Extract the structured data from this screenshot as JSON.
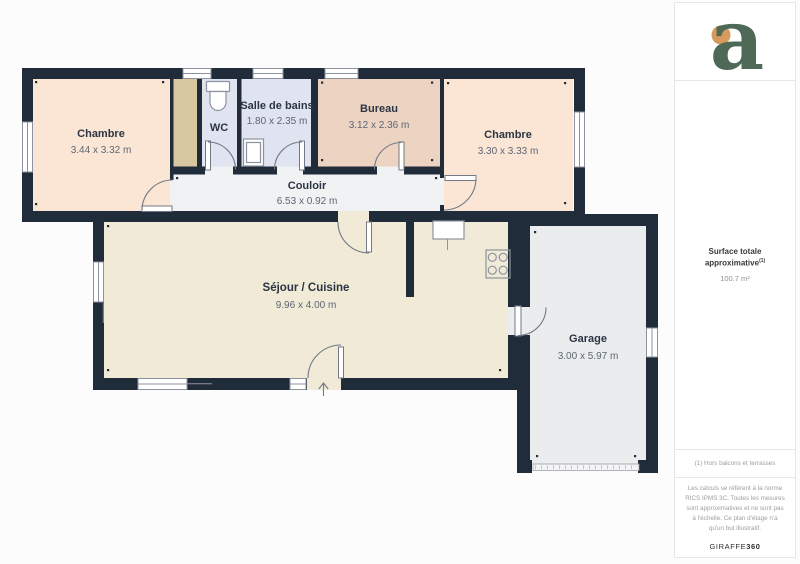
{
  "floorplan": {
    "rooms": [
      {
        "name": "Chambre",
        "dims": "3.44 x 3.32 m"
      },
      {
        "name": "WC",
        "dims": ""
      },
      {
        "name": "Salle de bains",
        "dims": "1.80 x 2.35 m"
      },
      {
        "name": "Bureau",
        "dims": "3.12 x 2.36 m"
      },
      {
        "name": "Chambre",
        "dims": "3.30 x 3.33 m"
      },
      {
        "name": "Couloir",
        "dims": "6.53 x 0.92 m"
      },
      {
        "name": "Séjour / Cuisine",
        "dims": "9.96 x 4.00 m"
      },
      {
        "name": "Garage",
        "dims": "3.00 x 5.97 m"
      }
    ],
    "icons": [
      "toilet-icon",
      "bathroom-sink-icon",
      "kitchen-sink-icon",
      "stove-icon",
      "entrance-arrow-icon",
      "window",
      "door-swing"
    ]
  },
  "sidebar": {
    "logo_letter": "a",
    "surface_label": "Surface totale approximative",
    "surface_sup": "(1)",
    "surface_value": "100.7 m²",
    "footnote": "(1) Hors balcons et terrasses",
    "disclaimer": "Les calculs se réfèrent à la norme RICS IPMS 3C. Toutes les mesures sont approximatives et ne sont pas à l'échelle. Ce plan d'étage n'a qu'un but illustratif.",
    "brand_name": "GIRAFFE",
    "brand_suffix": "360"
  },
  "colors": {
    "wall": "#212c3a",
    "peach": "#fbe6d6",
    "bureau": "#edd3c2",
    "blue": "#dfe4f0",
    "tan": "#d7c8a0",
    "corridor": "#f0f2f4",
    "cream": "#f0ead7",
    "garage": "#eaecee",
    "fix": "#8d939e",
    "door": "#727a86",
    "tdark": "#2c3543",
    "tdim": "#5c6673",
    "green": "#4e6a57",
    "orange": "#d59a5c",
    "border": "#e7e7e7",
    "muted": "#9e9e9e",
    "bg": "#fcfcfc"
  }
}
